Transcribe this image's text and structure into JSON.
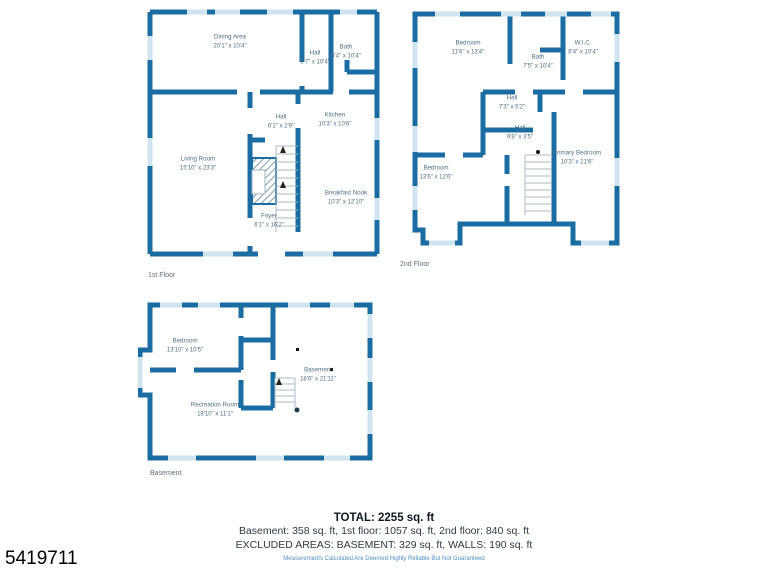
{
  "page": {
    "mls_number": "5419711"
  },
  "palette": {
    "wall_blue": "#1b6ca3",
    "window_light_blue": "#cfe4f0",
    "room_label_color": "#4e7087",
    "disclaimer_blue": "#4f8fc0"
  },
  "floors": [
    {
      "id": "first",
      "label": "1st Floor",
      "rooms": [
        {
          "name": "Dining Area",
          "dims": "20'1\" x 10'4\""
        },
        {
          "name": "Hall",
          "dims": "5'7\" x 10'4\""
        },
        {
          "name": "Bath",
          "dims": "6'4\" x 10'4\""
        },
        {
          "name": "Living Room",
          "dims": "15'10\" x 23'3\""
        },
        {
          "name": "Hall",
          "dims": "6'1\" x 2'9\""
        },
        {
          "name": "Kitchen",
          "dims": "10'3\" x 10'6\""
        },
        {
          "name": "Breakfast Nook",
          "dims": "10'3\" x 12'10\""
        },
        {
          "name": "Foyer",
          "dims": "6'1\" x 16'2\""
        }
      ]
    },
    {
      "id": "second",
      "label": "2nd Floor",
      "rooms": [
        {
          "name": "Bedroom",
          "dims": "11'6\" x 13'4\""
        },
        {
          "name": "Bath",
          "dims": "7'5\" x 10'4\""
        },
        {
          "name": "W.I.C.",
          "dims": "6'4\" x 10'4\""
        },
        {
          "name": "Hall",
          "dims": "7'3\" x 5'2\""
        },
        {
          "name": "Hall",
          "dims": "9'8\" x 3'5\""
        },
        {
          "name": "Bedroom",
          "dims": "13'6\" x 12'6\""
        },
        {
          "name": "Primary Bedroom",
          "dims": "10'3\" x 21'6\""
        }
      ]
    },
    {
      "id": "basement",
      "label": "Basement",
      "rooms": [
        {
          "name": "Bedroom",
          "dims": "13'10\" x 10'5\""
        },
        {
          "name": "Basement",
          "dims": "18'6\" x 21'11\""
        },
        {
          "name": "Recreation Room",
          "dims": "18'10\" x 11'1\""
        }
      ]
    }
  ],
  "summary": {
    "total": "TOTAL: 2255 sq. ft",
    "line2": "Basement: 358 sq. ft, 1st floor: 1057 sq. ft, 2nd floor: 840 sq. ft",
    "line3": "EXCLUDED AREAS: BASEMENT: 329 sq. ft, WALLS: 190 sq. ft",
    "disclaimer": "Measurements Calculated Are Deemed Highly Reliable But Not Guaranteed"
  }
}
